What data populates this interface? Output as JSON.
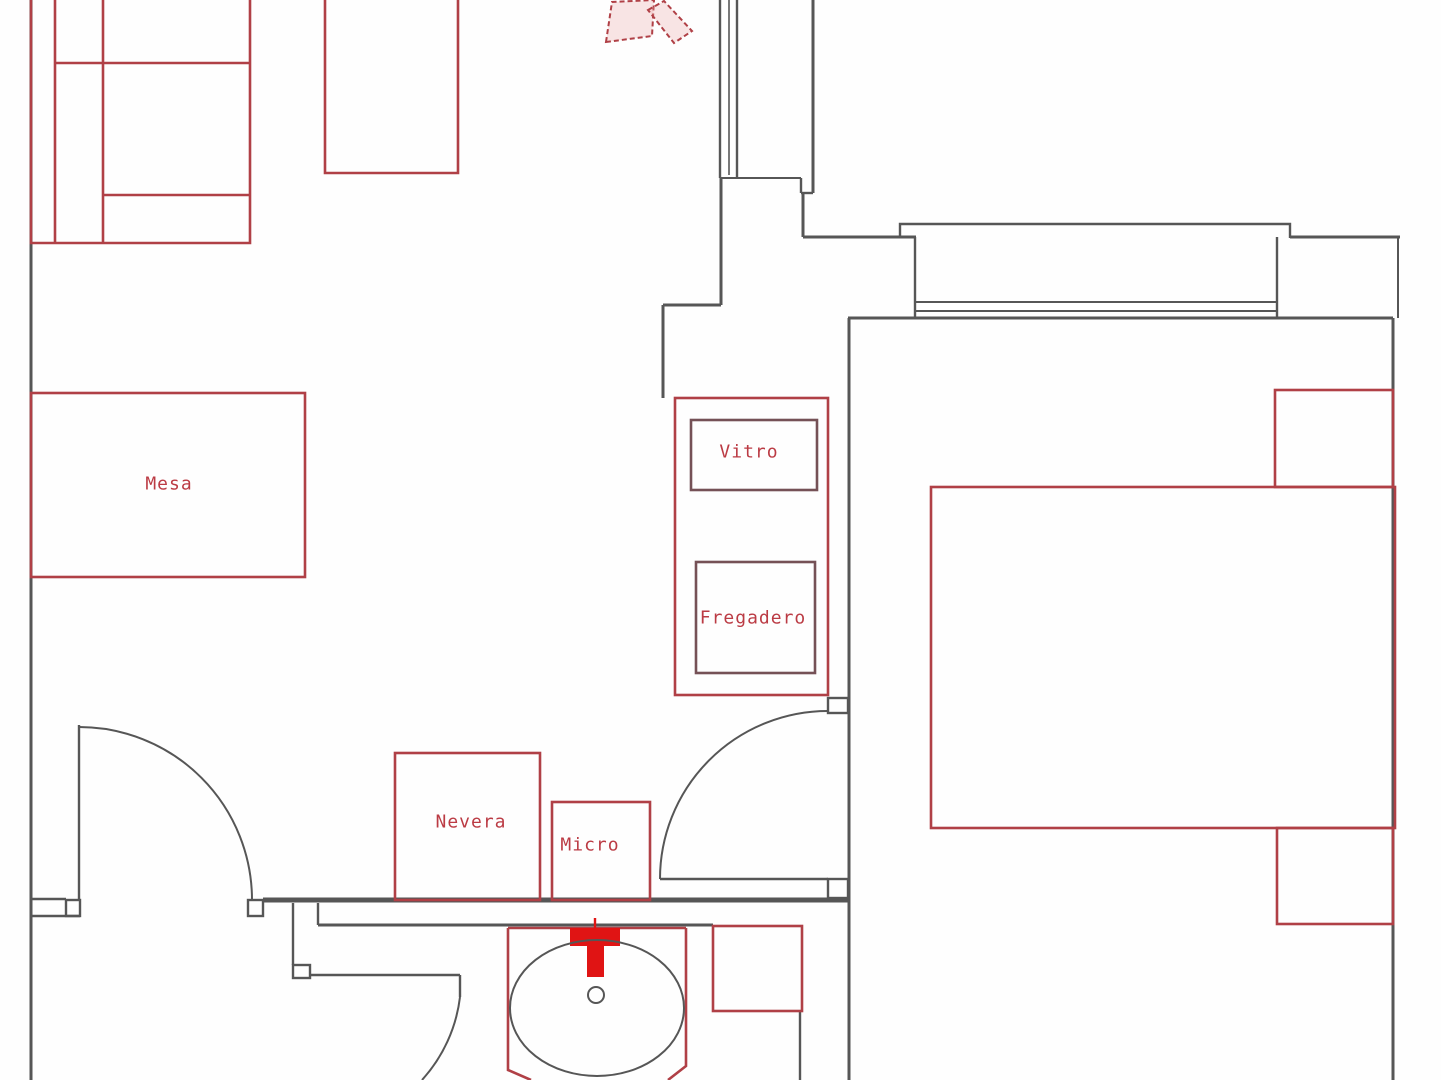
{
  "colors": {
    "background": "#fefefe",
    "wall": "#565656",
    "furniture": "#b04046",
    "furnitureDark": "#755156",
    "accent": "#e01414",
    "label": "#bb3b44"
  },
  "labels": {
    "mesa": {
      "text": "Mesa"
    },
    "vitro": {
      "text": "Vitro"
    },
    "fregadero": {
      "text": "Fregadero"
    },
    "nevera": {
      "text": "Nevera"
    },
    "micro": {
      "text": "Micro"
    }
  }
}
